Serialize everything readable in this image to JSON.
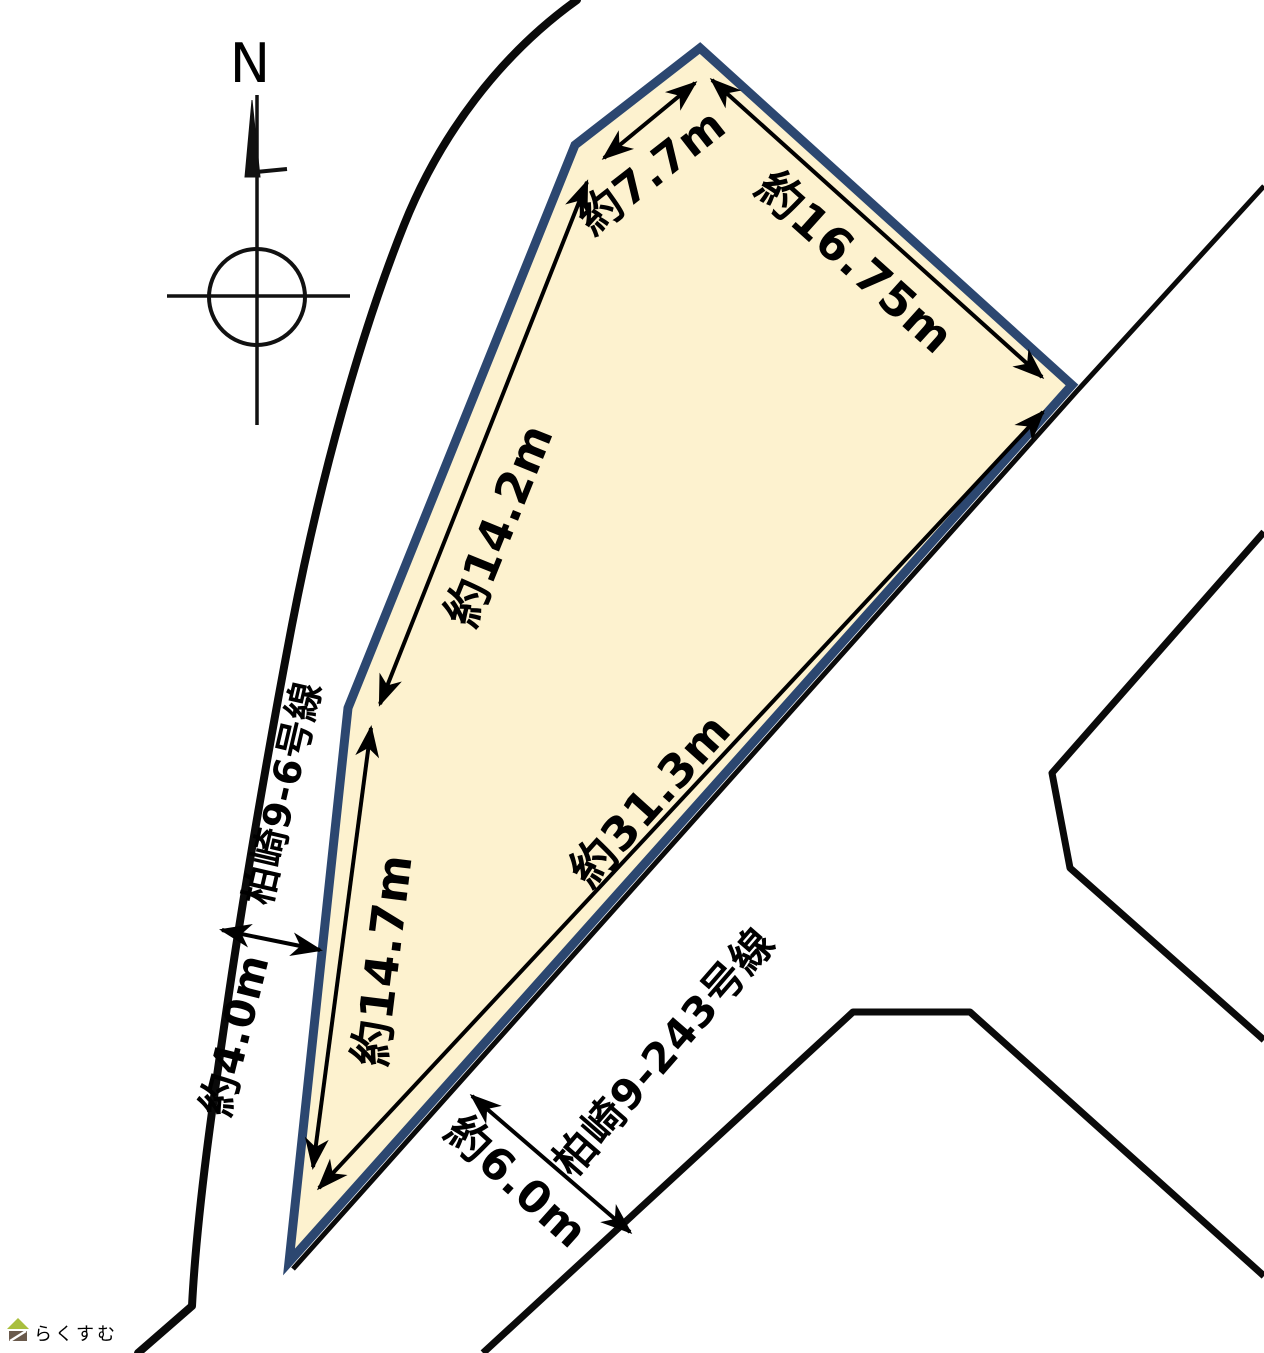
{
  "compass": {
    "north_label": "N"
  },
  "parcel": {
    "fill_color": "#fdf2cf",
    "border_color": "#2c4770",
    "edge_labels": {
      "northwest_short": "約7.7m",
      "northeast": "約16.75m",
      "west_upper": "約14.2m",
      "west_lower": "約14.7m",
      "southeast": "約31.3m"
    }
  },
  "roads": [
    {
      "name": "柏崎9-6号線",
      "width_label": "約4.0m"
    },
    {
      "name": "柏崎9-243号線",
      "width_label": "約6.0m"
    }
  ],
  "watermark": {
    "text": "らくすむ",
    "text_color": "#8d8078",
    "roof_color": "#a9bf3e",
    "body_color": "#6a5a4c"
  }
}
